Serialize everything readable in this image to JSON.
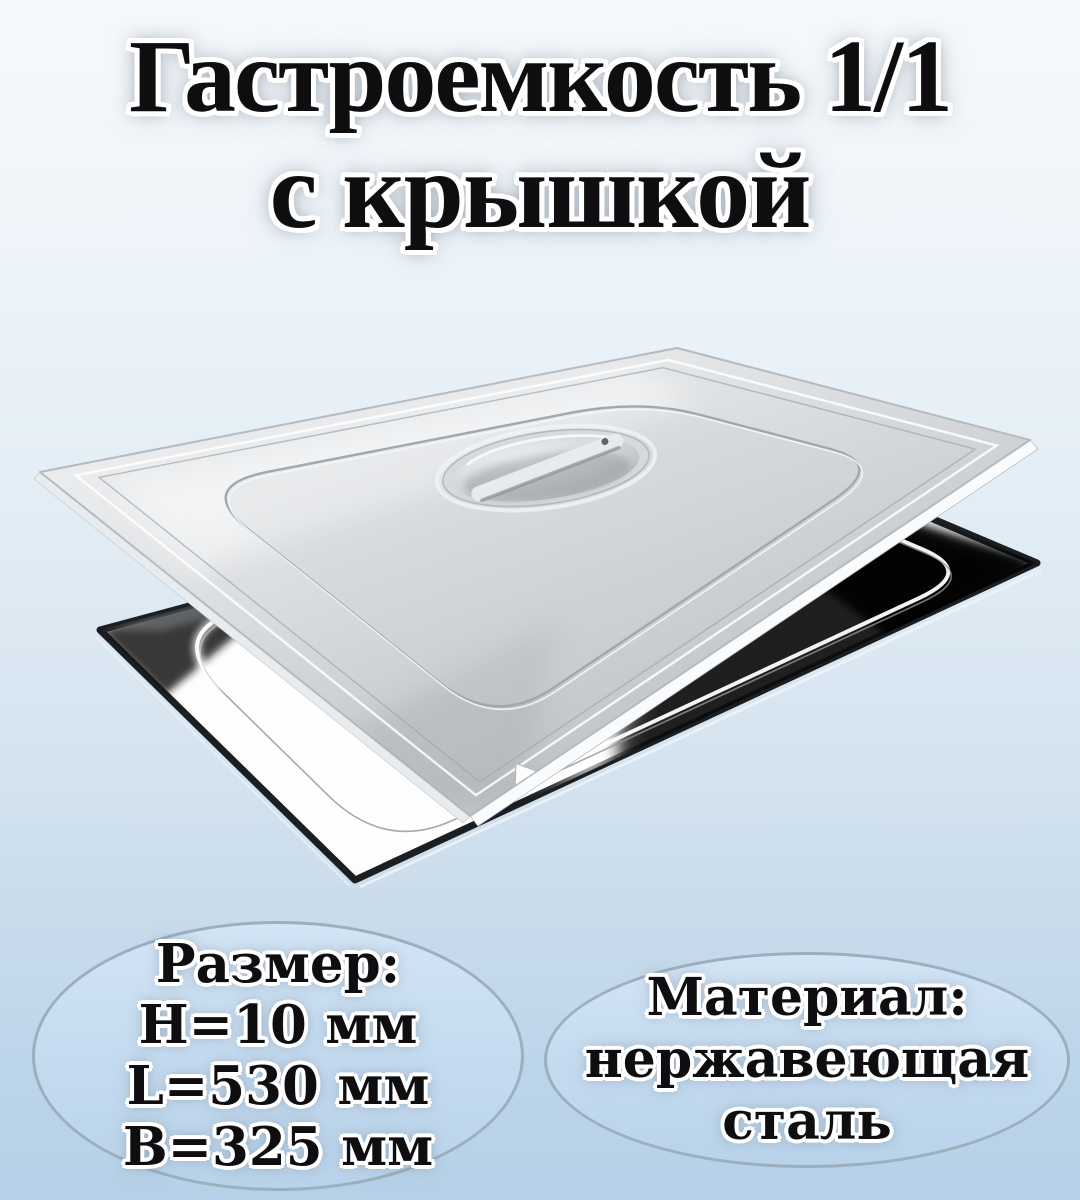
{
  "title": {
    "line1": "Гастроемкость 1/1",
    "line2": "с крышкой"
  },
  "badges": {
    "size": {
      "heading": "Размер:",
      "lines": [
        "H=10 мм",
        "L=530 мм",
        "B=325 мм"
      ]
    },
    "material": {
      "heading": "Материал:",
      "lines": [
        "нержавеющая",
        "сталь"
      ]
    }
  },
  "icons": {
    "product_image": "stainless-steel-gastronorm-pan-with-lid-photo"
  },
  "colors": {
    "background_top": "#f6f9fb",
    "background_bottom": "#b5d0e7",
    "badge_fill_top": "#d3e5f5",
    "badge_fill_bottom": "#b9d3ea",
    "badge_border": "#9dafbe",
    "text": "#0e0e10",
    "text_outline": "#ffffff",
    "steel_light": "#f1f2f3",
    "steel_mid": "#c3c7ca",
    "steel_dark": "#0b0d0f"
  }
}
